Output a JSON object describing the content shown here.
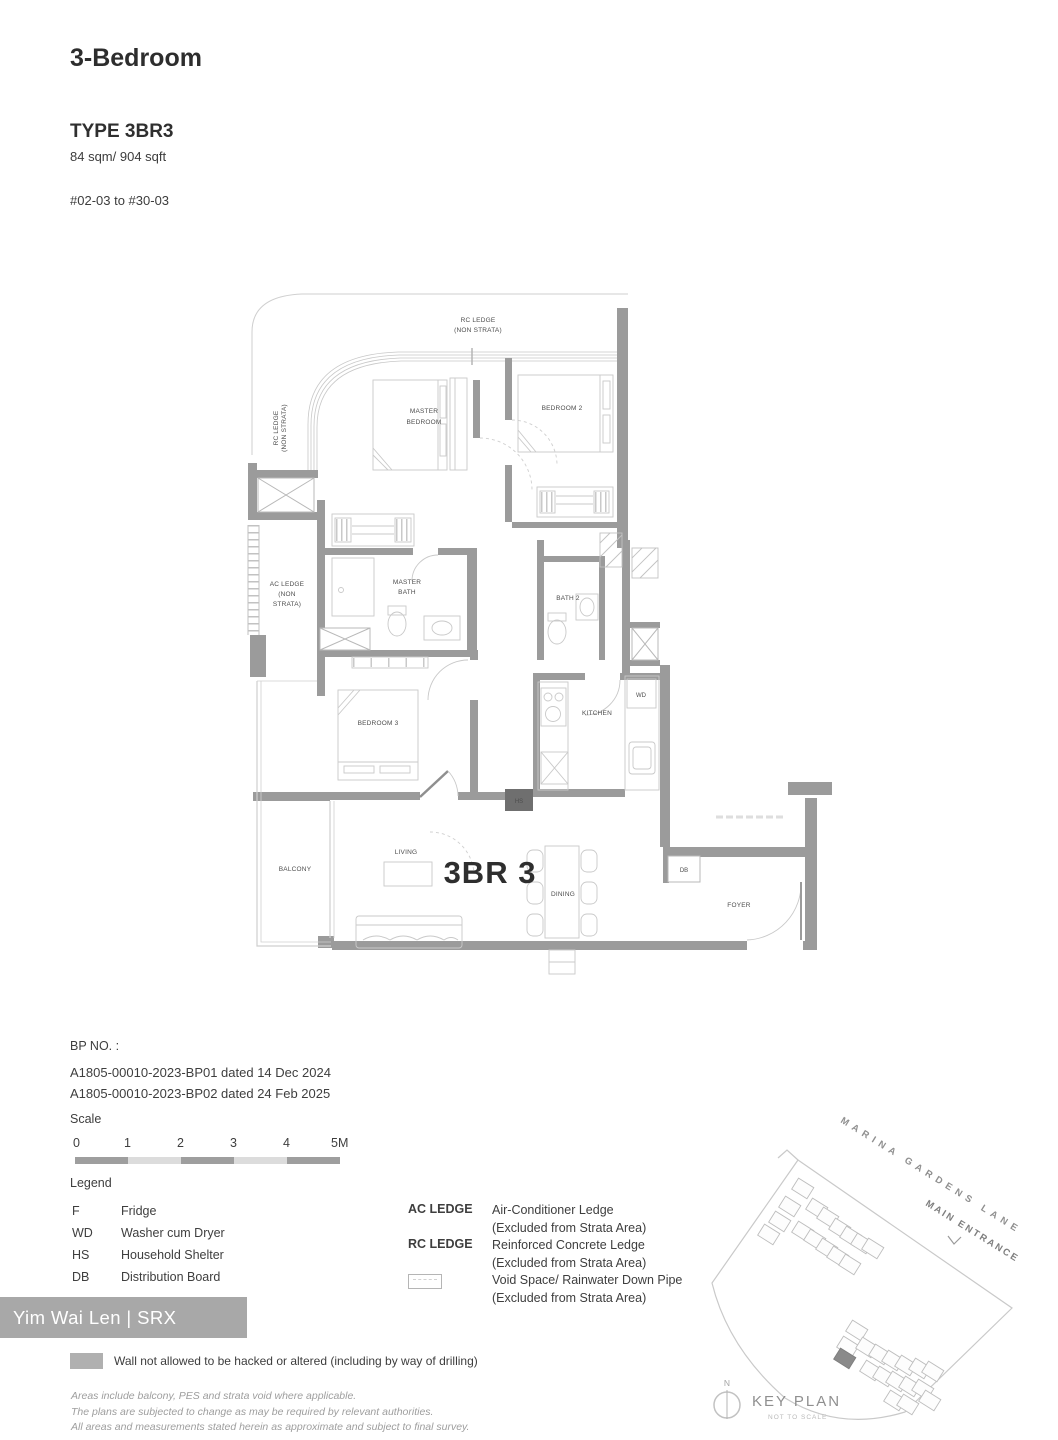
{
  "header": {
    "category": "3-Bedroom",
    "type": "TYPE 3BR3",
    "area": "84 sqm/ 904 sqft",
    "stack": "#02-03 to #30-03"
  },
  "floorplan": {
    "unit_label": "3BR 3",
    "labels": {
      "rc_ledge_top": [
        "RC LEDGE",
        "(NON STRATA)"
      ],
      "rc_ledge_left": [
        "RC LEDGE",
        "(NON STRATA)"
      ],
      "ac_ledge": [
        "AC LEDGE",
        "(NON",
        "STRATA)"
      ],
      "master_bedroom": [
        "MASTER",
        "BEDROOM"
      ],
      "master_bath": [
        "MASTER",
        "BATH"
      ],
      "bedroom_2": "BEDROOM 2",
      "bedroom_3": "BEDROOM 3",
      "bath_2": "BATH 2",
      "kitchen": "KITCHEN",
      "wd": "WD",
      "hs": "HS",
      "db": "DB",
      "living": "LIVING",
      "dining": "DINING",
      "balcony": "BALCONY",
      "foyer": "FOYER"
    }
  },
  "bp": {
    "heading": "BP NO. :",
    "lines": [
      "A1805-00010-2023-BP01 dated 14 Dec 2024",
      "A1805-00010-2023-BP02 dated 24 Feb 2025"
    ]
  },
  "scale": {
    "label": "Scale",
    "ticks": [
      "0",
      "1",
      "2",
      "3",
      "4",
      "5M"
    ]
  },
  "legend": {
    "title": "Legend",
    "items": [
      {
        "abbr": "F",
        "desc": "Fridge"
      },
      {
        "abbr": "WD",
        "desc": "Washer cum Dryer"
      },
      {
        "abbr": "HS",
        "desc": "Household Shelter"
      },
      {
        "abbr": "DB",
        "desc": "Distribution Board"
      }
    ],
    "ledges": [
      {
        "term": "AC LEDGE",
        "desc": "Air-Conditioner Ledge",
        "note": "(Excluded from Strata Area)"
      },
      {
        "term": "RC LEDGE",
        "desc": "Reinforced Concrete Ledge",
        "note": "(Excluded from Strata Area)"
      },
      {
        "term": "",
        "desc": "Void Space/ Rainwater Down Pipe",
        "note": "(Excluded from Strata Area)"
      }
    ],
    "wall_note": "Wall not allowed to be hacked or altered (including by way of drilling)"
  },
  "watermark": "Yim Wai Len | SRX PROPERTY",
  "disclaimer": [
    "Areas include balcony, PES and strata void where applicable.",
    "The plans are subjected to change as may be required by relevant authorities.",
    "All areas and measurements stated herein as approximate and subject to final survey."
  ],
  "keyplan": {
    "street": "MARINA GARDENS LANE",
    "entrance": "MAIN ENTRANCE",
    "title": "KEY PLAN",
    "subtitle": "NOT TO SCALE",
    "north": "N"
  },
  "colors": {
    "wall": "#9b9b9b",
    "thin_line": "#c9c9c9",
    "text": "#3a3a3a",
    "watermark_bg": "#a8a8a8",
    "watermark_text": "#ffffff"
  }
}
